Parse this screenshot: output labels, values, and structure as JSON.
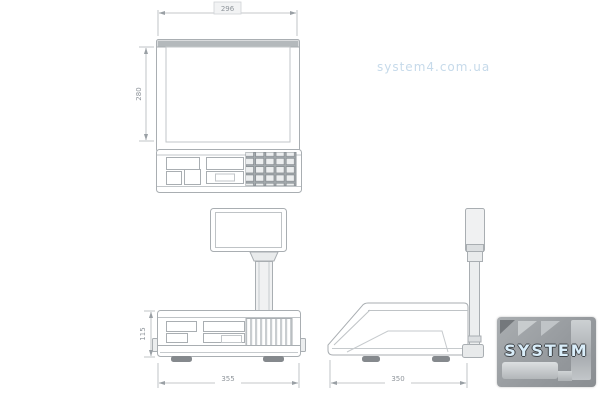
{
  "page": {
    "type": "technical-dimension-drawing",
    "subject": "retail weighing scale with pole display",
    "background": "#ffffff"
  },
  "watermark": {
    "text": "system4.com.ua",
    "color": "#a8c6de"
  },
  "logo": {
    "text": "SYSTEM",
    "digit": "4",
    "name": "system-4-logo"
  },
  "drawing": {
    "views": [
      "top-view",
      "front-view",
      "side-view"
    ],
    "dimensions": {
      "top_width": "296",
      "top_depth": "280",
      "front_height": "115",
      "front_width": "355",
      "side_depth": "350"
    },
    "colors": {
      "line": "#a9aeb2",
      "dim_line": "#b0b5b9",
      "dim_text": "#8f959b",
      "fill_light": "#f0f1f2",
      "platter_bar": "#b4b9bc",
      "feet": "#85898d",
      "logo_bg": "#969a9e",
      "logo_text": "#d9edf9"
    }
  }
}
